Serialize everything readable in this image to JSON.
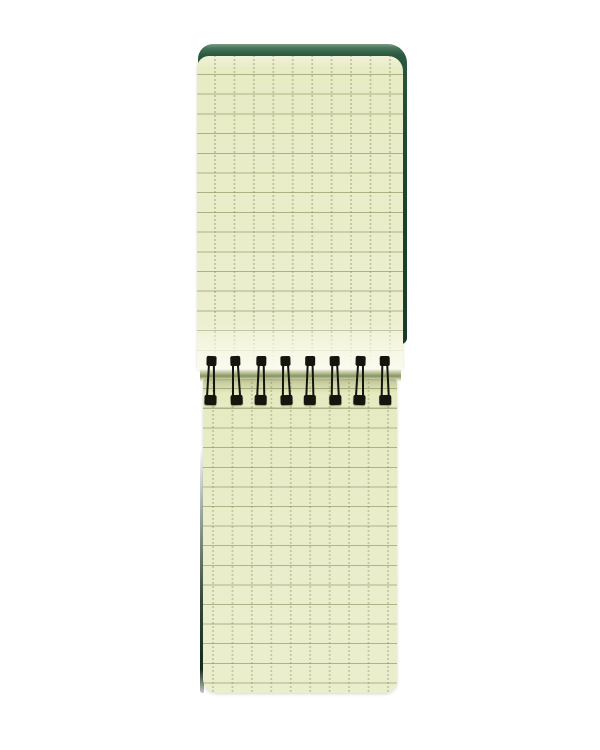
{
  "scene": {
    "type": "product-photograph",
    "description": "Open pocket-size spiral notepad with a dark green cover and pale green grid paper; black wire-o binding runs horizontally across the middle; pages have solid horizontal rules and dotted vertical rules on a white background",
    "background_color": "#ffffff"
  },
  "notebook": {
    "spiral_loop_count": 8,
    "top_page": {
      "visible_grid_rows": 15,
      "visible_grid_columns": 10
    },
    "bottom_page": {
      "visible_grid_rows": 15,
      "visible_grid_columns": 10
    },
    "grid": {
      "cell_size_px": 20,
      "horizontal_rule_style": "solid",
      "vertical_rule_style": "dotted"
    }
  },
  "colors": {
    "background": "#ffffff",
    "cover": "#2b5840",
    "cover_dark": "#1c402e",
    "cover_edge": "#7c9c85",
    "paper": "#e9edca",
    "paper_highlight": "#f7f8e8",
    "grid_line": "#868d5a",
    "grid_dot": "#949a66",
    "fold_band": "#87925a",
    "spiral": "#15150d"
  }
}
